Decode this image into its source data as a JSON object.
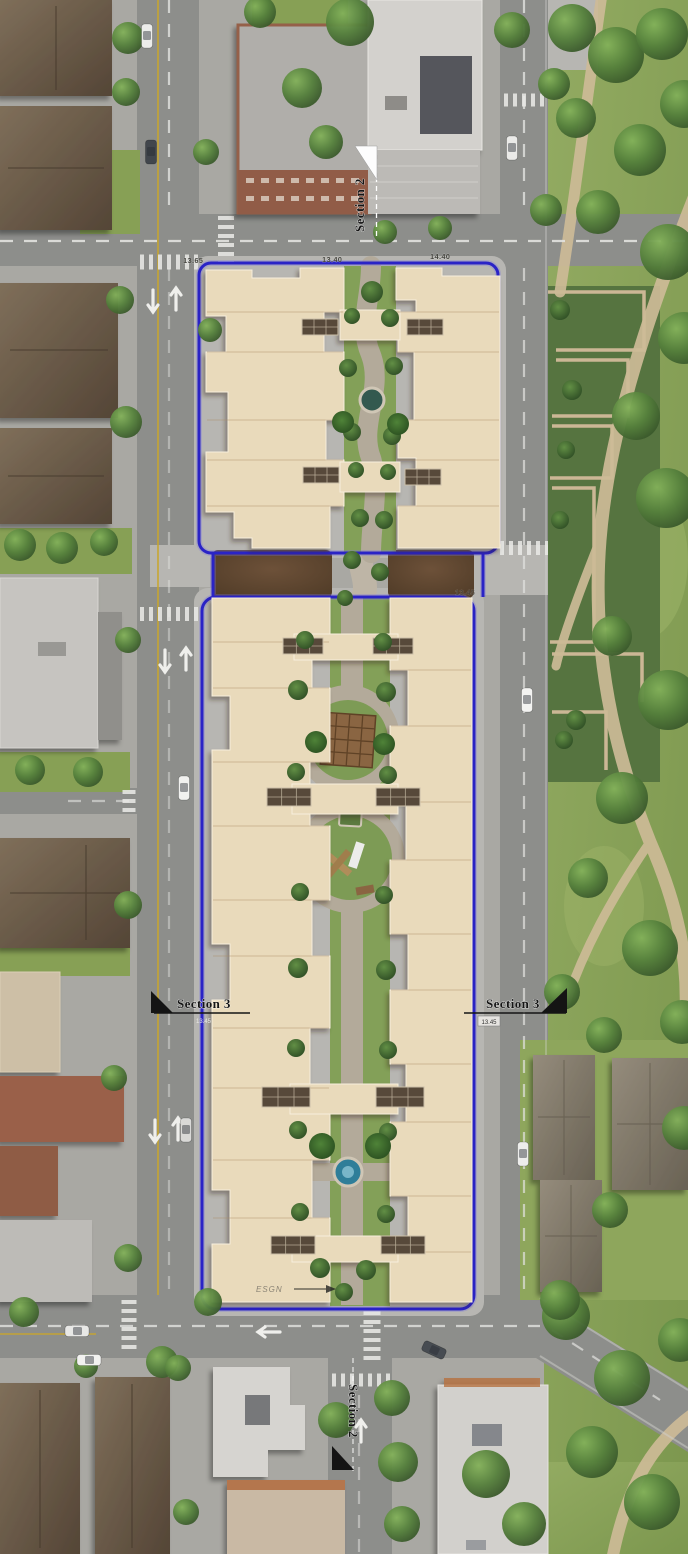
{
  "markers": {
    "section2_top": "Section 2",
    "section2_bottom": "Section 2",
    "section3_left": "Section 3",
    "section3_right": "Section 3"
  },
  "elevations": {
    "top_left": "13.65",
    "top_center": "13.40",
    "top_right": "14.40",
    "mid_right": "13.45",
    "section3_left_tag": "13.45",
    "section3_right_tag": "13.45"
  },
  "annotations": {
    "entry_label": "ESGN"
  },
  "colors": {
    "boundary_blue": "#2a23c6",
    "road_gray": "#8d8e8b",
    "sidewalk_gray": "#b7b6b2",
    "park_green": "#87a055",
    "roof_beige": "#e9dabb",
    "dirt_brown": "#5d4431",
    "path_tan": "#cdbb97",
    "lane_yellow": "#c9a62e"
  }
}
